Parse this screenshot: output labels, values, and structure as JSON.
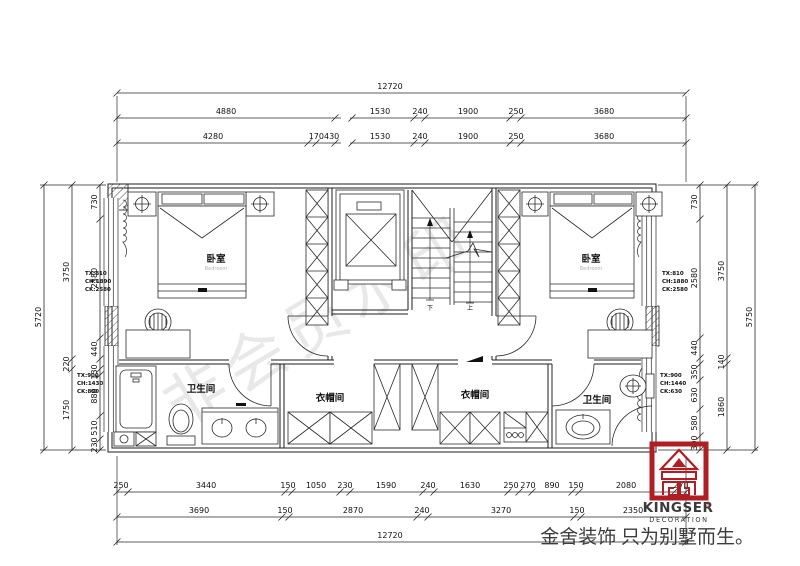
{
  "meta": {
    "watermark": "非会员水印"
  },
  "rooms": {
    "bedroom_left": {
      "label": "卧室",
      "sub": "Bedroom"
    },
    "bedroom_right": {
      "label": "卧室",
      "sub": "Bedroom"
    },
    "bath_left": {
      "label": "卫生间"
    },
    "closet_left": {
      "label": "衣帽间"
    },
    "closet_right": {
      "label": "衣帽间"
    },
    "bath_right": {
      "label": "卫生间"
    }
  },
  "notes": {
    "left_upper": {
      "l1": "TX:810",
      "l2": "CH:1890",
      "l3": "CK:2580"
    },
    "left_lower": {
      "l1": "TX:900",
      "l2": "CH:1430",
      "l3": "CK:890"
    },
    "right_upper": {
      "l1": "TX:810",
      "l2": "CH:1880",
      "l3": "CK:2580"
    },
    "right_lower": {
      "l1": "TX:900",
      "l2": "CH:1440",
      "l3": "CK:630"
    }
  },
  "stairs": {
    "down": "下",
    "up": "上"
  },
  "dims": {
    "top_total": "12720",
    "top_row2": [
      "4880",
      "1530",
      "240",
      "1900",
      "250",
      "3680"
    ],
    "top_row3": [
      "4280",
      "170430",
      "1530",
      "240",
      "1900",
      "250",
      "3680"
    ],
    "left_inner": [
      "730",
      "2580",
      "440",
      "130",
      "880",
      "510",
      "230"
    ],
    "left_mid": [
      "3750",
      "220",
      "1750"
    ],
    "left_total": "5720",
    "right_inner": [
      "730",
      "2580",
      "440",
      "350",
      "630",
      "580",
      "300"
    ],
    "right_mid": [
      "3750",
      "140",
      "1860"
    ],
    "right_total": "5750",
    "bottom_row1": [
      "250",
      "3440",
      "150",
      "1050",
      "230",
      "1590",
      "240",
      "1630",
      "250",
      "270",
      "890",
      "150",
      "2080",
      "270"
    ],
    "bottom_row2": [
      "3690",
      "150",
      "2870",
      "240",
      "3270",
      "150",
      "2350"
    ],
    "bottom_total": "12720"
  },
  "brand": {
    "name": "KINGSER",
    "reg": "®",
    "sub": "DECORATION",
    "tagline": "金舍装饰 只为别墅而生。",
    "red": "#b01e23"
  }
}
